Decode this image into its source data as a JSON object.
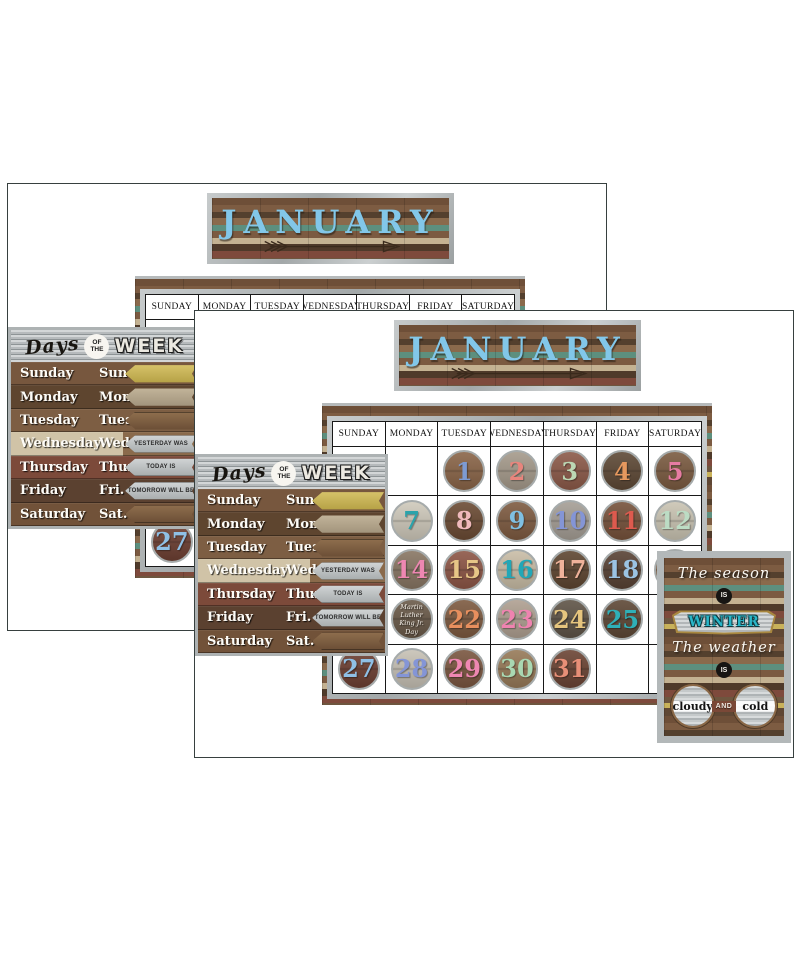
{
  "panel": {
    "banner": {
      "month": "JANUARY",
      "month_color": "#82c7e9"
    },
    "calendar": {
      "day_headers": [
        "SUNDAY",
        "MONDAY",
        "TUESDAY",
        "WEDNESDAY",
        "THURSDAY",
        "FRIDAY",
        "SATURDAY"
      ],
      "days": [
        {
          "num": "1",
          "row": 0,
          "col": 2,
          "bg": "#8a6548",
          "fg": "#7d9bd3"
        },
        {
          "num": "2",
          "row": 0,
          "col": 3,
          "bg": "#a59a8b",
          "fg": "#e8857d"
        },
        {
          "num": "3",
          "row": 0,
          "col": 4,
          "bg": "#8c5a49",
          "fg": "#bcd8b4"
        },
        {
          "num": "4",
          "row": 0,
          "col": 5,
          "bg": "#5e4936",
          "fg": "#e6985e"
        },
        {
          "num": "5",
          "row": 0,
          "col": 6,
          "bg": "#7b5b41",
          "fg": "#e77ca3"
        },
        {
          "num": "7",
          "row": 1,
          "col": 1,
          "bg": "#cfc9bb",
          "fg": "#2ba3ab"
        },
        {
          "num": "8",
          "row": 1,
          "col": 2,
          "bg": "#6b4b34",
          "fg": "#efb9bc"
        },
        {
          "num": "9",
          "row": 1,
          "col": 3,
          "bg": "#7e5b41",
          "fg": "#7fc0e2"
        },
        {
          "num": "10",
          "row": 1,
          "col": 4,
          "bg": "#a59e95",
          "fg": "#8495d6"
        },
        {
          "num": "11",
          "row": 1,
          "col": 5,
          "bg": "#76523b",
          "fg": "#dd5a4e"
        },
        {
          "num": "12",
          "row": 1,
          "col": 6,
          "bg": "#cac4b3",
          "fg": "#bcdcc4"
        },
        {
          "num": "14",
          "row": 2,
          "col": 1,
          "bg": "#887663",
          "fg": "#ee87b2"
        },
        {
          "num": "15",
          "row": 2,
          "col": 2,
          "bg": "#8d5646",
          "fg": "#e7c687"
        },
        {
          "num": "16",
          "row": 2,
          "col": 3,
          "bg": "#c9bda6",
          "fg": "#22a7b7"
        },
        {
          "num": "17",
          "row": 2,
          "col": 4,
          "bg": "#5e4631",
          "fg": "#efb29a"
        },
        {
          "num": "18",
          "row": 2,
          "col": 5,
          "bg": "#584234",
          "fg": "#9bc3e3"
        },
        {
          "num": "19",
          "row": 2,
          "col": 6,
          "bg": "#8a6a50",
          "fg": "#8aabdc"
        },
        {
          "num": "21",
          "row": 3,
          "col": 1,
          "bg": "#6a5a49",
          "fg": "#f3efe8",
          "label": [
            "Martin",
            "Luther King Jr.",
            "Day"
          ]
        },
        {
          "num": "22",
          "row": 3,
          "col": 2,
          "bg": "#7d5a40",
          "fg": "#e78f5e"
        },
        {
          "num": "23",
          "row": 3,
          "col": 3,
          "bg": "#afa091",
          "fg": "#ef83b0"
        },
        {
          "num": "24",
          "row": 3,
          "col": 4,
          "bg": "#5f5447",
          "fg": "#e6c57e"
        },
        {
          "num": "25",
          "row": 3,
          "col": 5,
          "bg": "#5e4836",
          "fg": "#2fb0b8"
        },
        {
          "num": "27",
          "row": 4,
          "col": 0,
          "bg": "#6e4033",
          "fg": "#8fc0e6"
        },
        {
          "num": "28",
          "row": 4,
          "col": 1,
          "bg": "#c7c1b5",
          "fg": "#8495d6"
        },
        {
          "num": "29",
          "row": 4,
          "col": 2,
          "bg": "#7a5640",
          "fg": "#ee87b2"
        },
        {
          "num": "30",
          "row": 4,
          "col": 3,
          "bg": "#977a58",
          "fg": "#a9d8b2"
        },
        {
          "num": "31",
          "row": 4,
          "col": 4,
          "bg": "#6b4434",
          "fg": "#e78f77"
        }
      ]
    },
    "days_chart": {
      "title": {
        "script": "Days",
        "badge_top": "OF",
        "badge_bottom": "THE",
        "main": "WEEK"
      },
      "rows": [
        {
          "name": "Sunday",
          "abbr": "Sun.",
          "arrow": "yellow",
          "arrow_label": ""
        },
        {
          "name": "Monday",
          "abbr": "Mon.",
          "arrow": "tan",
          "arrow_label": ""
        },
        {
          "name": "Tuesday",
          "abbr": "Tues.",
          "arrow": "wood",
          "arrow_label": ""
        },
        {
          "name": "Wednesday",
          "abbr": "Wed.",
          "arrow": "metal",
          "arrow_label": "YESTERDAY WAS"
        },
        {
          "name": "Thursday",
          "abbr": "Thurs.",
          "arrow": "metal",
          "arrow_label": "TODAY IS"
        },
        {
          "name": "Friday",
          "abbr": "Fri.",
          "arrow": "metal",
          "arrow_label": "TOMORROW WILL BE"
        },
        {
          "name": "Saturday",
          "abbr": "Sat.",
          "arrow": "wood",
          "arrow_label": ""
        }
      ]
    },
    "sign": {
      "line1": "The season",
      "is_label": "IS",
      "season": "WINTER",
      "line2": "The weather",
      "weather1": "cloudy",
      "conj": "AND",
      "weather2": "cold",
      "season_color": "#29b6c8"
    }
  }
}
